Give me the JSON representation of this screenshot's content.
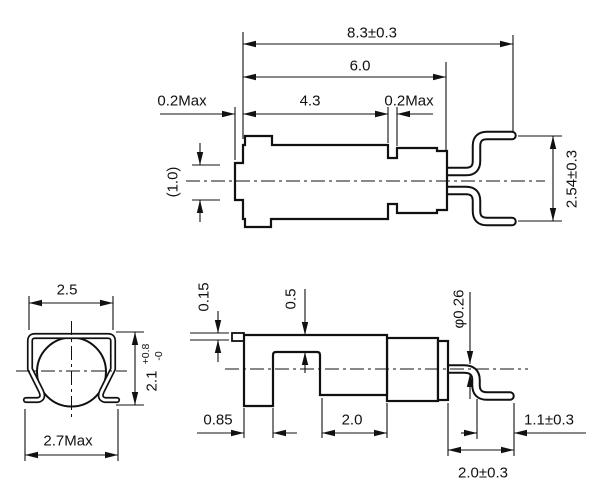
{
  "colors": {
    "line": "#111111",
    "background": "#ffffff"
  },
  "views": {
    "top_side": {
      "dims": {
        "overall": "8.3±0.3",
        "holder": "6.0",
        "can": "4.3",
        "gap_left": "0.2Max",
        "gap_right": "0.2Max",
        "stem": "(1.0)",
        "pitch": "2.54±0.3"
      }
    },
    "end": {
      "dims": {
        "top_width": "2.5",
        "height": "2.1",
        "height_plus": "+0.8",
        "height_minus": "-0",
        "overall_width": "2.7Max"
      }
    },
    "bottom_side": {
      "dims": {
        "tab": "0.15",
        "step": "0.5",
        "lead_dia": "φ0.26",
        "foot": "0.85",
        "window": "2.0",
        "lead_tip": "1.1±0.3",
        "lead_run": "2.0±0.3"
      }
    }
  }
}
